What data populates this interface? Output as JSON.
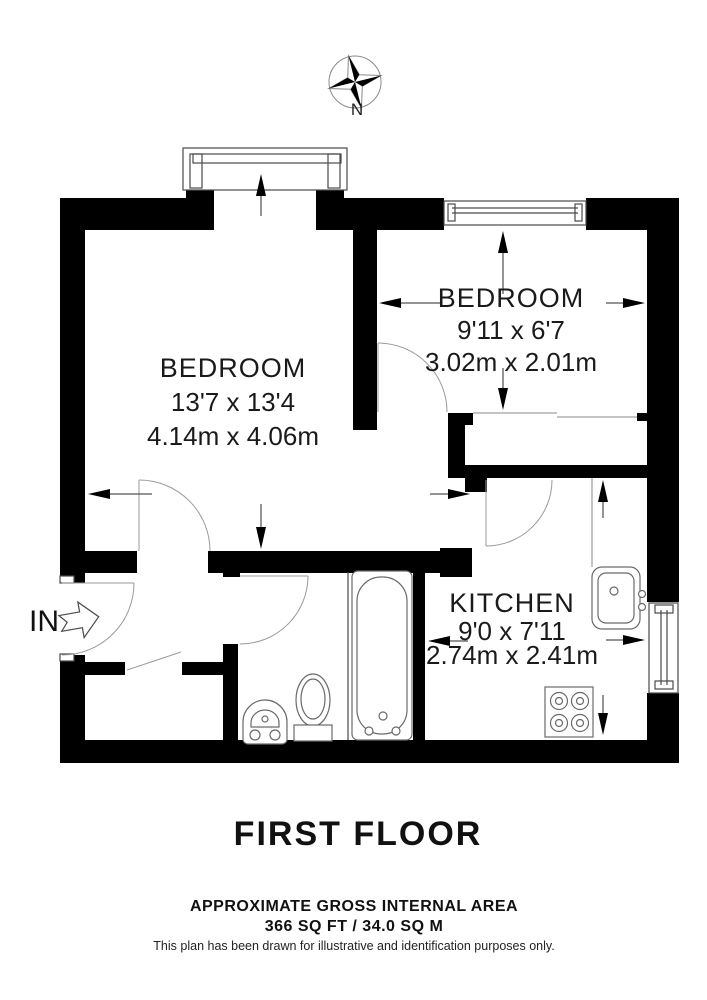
{
  "compass": {
    "north_label": "N"
  },
  "entry": {
    "label": "IN"
  },
  "rooms": [
    {
      "id": "bedroom-1",
      "name": "BEDROOM",
      "imperial": "13'7 x 13'4",
      "metric": "4.14m x 4.06m"
    },
    {
      "id": "bedroom-2",
      "name": "BEDROOM",
      "imperial": "9'11 x 6'7",
      "metric": "3.02m x 2.01m"
    },
    {
      "id": "kitchen",
      "name": "KITCHEN",
      "imperial": "9'0 x 7'11",
      "metric": "2.74m x 2.41m"
    }
  ],
  "title": "FIRST FLOOR",
  "footer": {
    "area_heading": "APPROXIMATE GROSS INTERNAL AREA",
    "area_value": "366 SQ FT / 34.0 SQ M",
    "disclaimer": "This plan has been drawn for illustrative and identification purposes only."
  },
  "colors": {
    "wall": "#000000",
    "background": "#ffffff",
    "thin_line": "#4a4a4a",
    "door_arc": "#9a9a9a",
    "text": "#1a1a1a"
  }
}
